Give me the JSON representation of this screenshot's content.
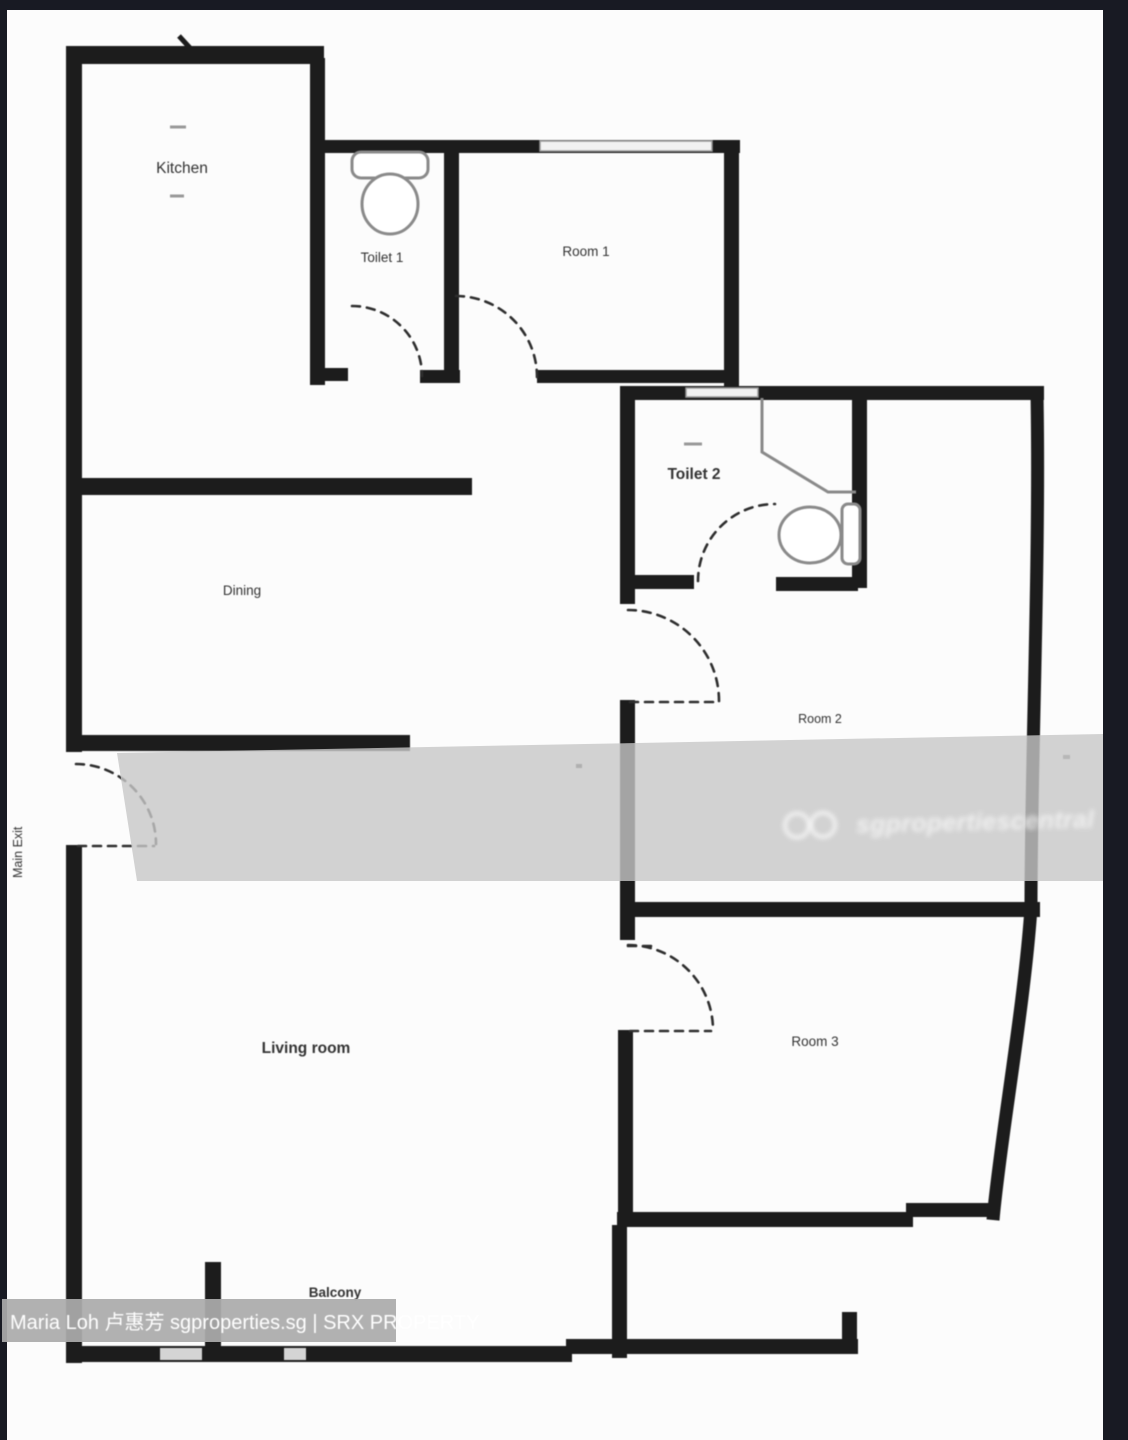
{
  "page": {
    "type": "residential-floor-plan-photo"
  },
  "rooms": {
    "kitchen": "Kitchen",
    "toilet1": "Toilet 1",
    "room1": "Room 1",
    "toilet2": "Toilet 2",
    "dining": "Dining",
    "room2": "Room 2",
    "living": "Living room",
    "room3": "Room 3",
    "balcony": "Balcony",
    "main_exit": "Main Exit"
  },
  "watermark": {
    "logo": "double-loop-infinity",
    "text": "sgpropertiescentral"
  },
  "caption": {
    "full": "Maria Loh 卢惠芳 sgproperties.sg | SRX PROPERTY",
    "agent_name": "Maria Loh 卢惠芳",
    "website": "sgproperties.sg",
    "brand": "SRX PROPERTY"
  },
  "colors": {
    "background": "#181a23",
    "paper": "#fcfcfc",
    "wall": "#1c1c1c",
    "watermark_band": "#c7c7c7",
    "caption_band": "#ababab",
    "caption_text": "#ffffff",
    "label_text": "#333333"
  }
}
